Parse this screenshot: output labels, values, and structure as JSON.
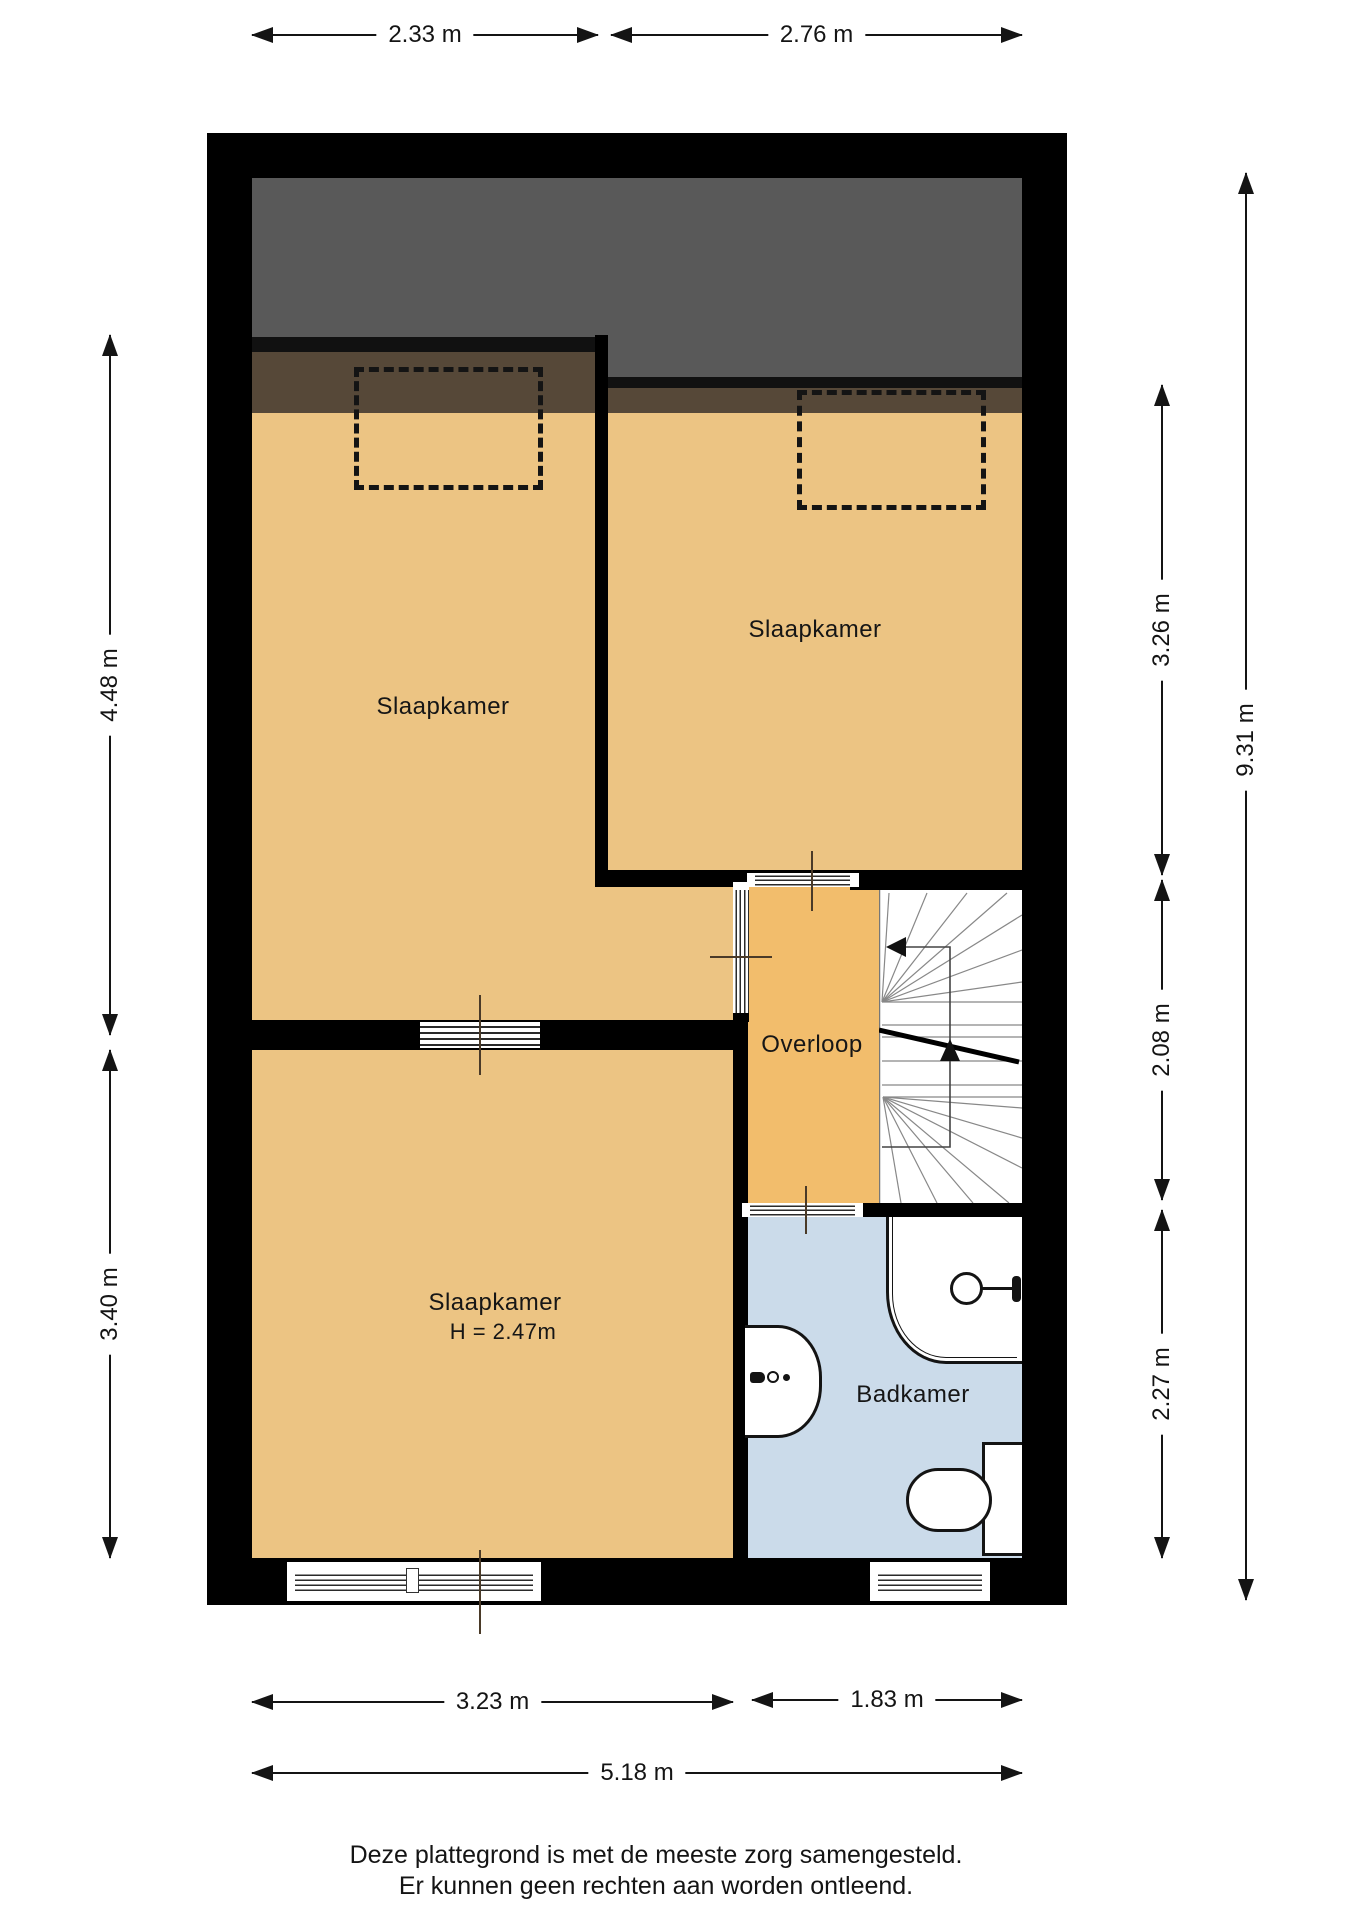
{
  "rooms": {
    "bedroom_left": {
      "label": "Slaapkamer"
    },
    "bedroom_top_right": {
      "label": "Slaapkamer"
    },
    "bedroom_bottom": {
      "label": "Slaapkamer",
      "height_note": "H = 2.47m"
    },
    "landing": {
      "label": "Overloop"
    },
    "bathroom": {
      "label": "Badkamer"
    }
  },
  "dimensions": {
    "top_left": "2.33 m",
    "top_right": "2.76 m",
    "left_upper": "4.48 m",
    "left_lower": "3.40 m",
    "right_upper": "3.26 m",
    "right_middle": "2.08 m",
    "right_lower": "2.27 m",
    "right_total": "9.31 m",
    "bottom_left": "3.23 m",
    "bottom_right": "1.83 m",
    "bottom_total": "5.18 m"
  },
  "footer": {
    "line1": "Deze plattegrond is met de meeste zorg samengesteld.",
    "line2": "Er kunnen geen rechten aan worden ontleend."
  },
  "colors": {
    "wall": "#000000",
    "floor": "#ecc483",
    "landing_floor": "#f2bd6c",
    "bathroom_floor": "#cbdbea",
    "roof_void": "#595959",
    "roof_band": "#564838"
  }
}
